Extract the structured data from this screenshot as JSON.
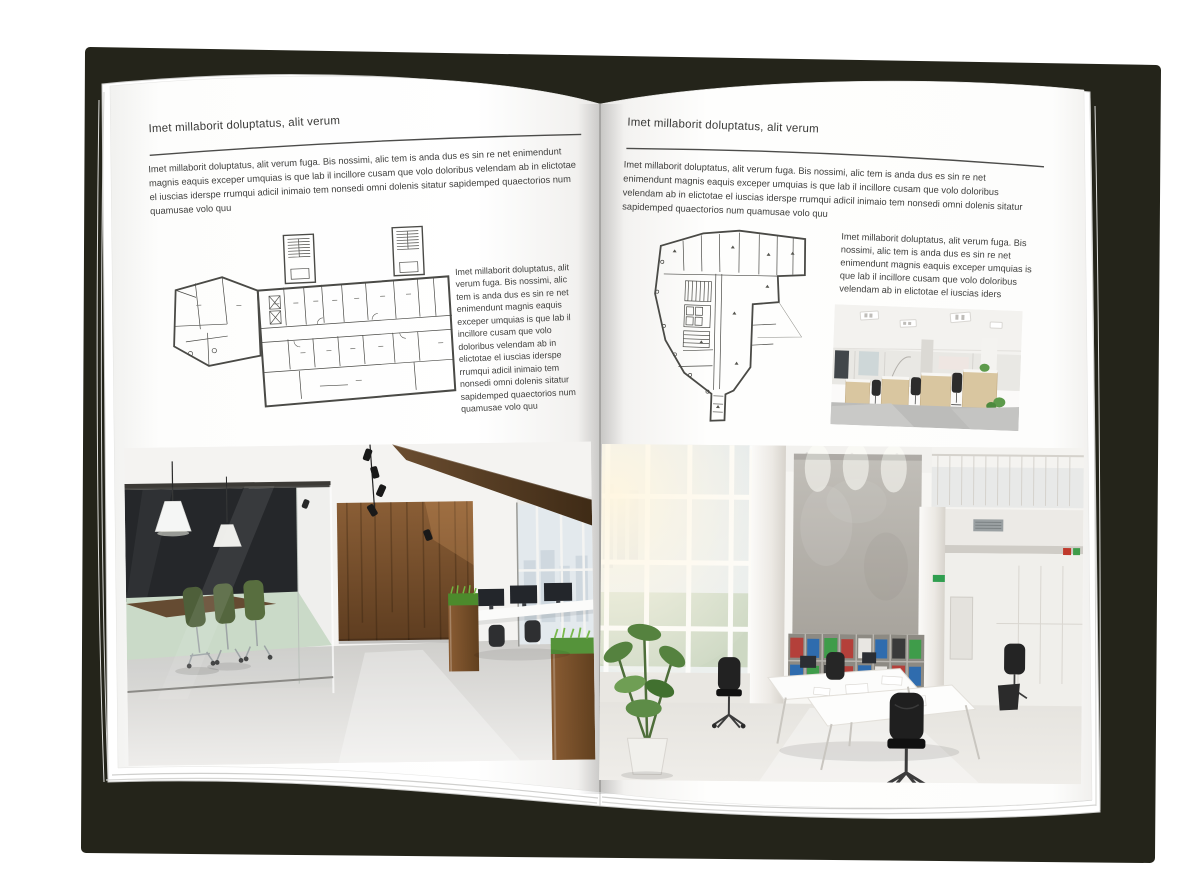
{
  "colors": {
    "cover": "#24241a",
    "page": "#ffffff",
    "heading_text": "#3a3a38",
    "body_text": "#3f3f3d",
    "rule": "#4c4c4a"
  },
  "left_page": {
    "header": "Imet millaborit doluptatus, alit verum",
    "intro": "Imet millaborit doluptatus, alit verum fuga. Bis nossimi, alic tem is anda dus es sin re net enimendunt magnis eaquis exceper umquias is que lab il incillore cusam que volo doloribus velendam ab in elictotae el iuscias iderspe rrumqui adicil inimaio tem nonsedi omni dolenis sitatur sapidemped quaectorios num quamusae volo quu",
    "side_text": "Imet millaborit doluptatus, alit verum fuga. Bis nossimi, alic tem is anda dus es sin re net enimendunt magnis eaquis exceper umquias is que lab il incillore cusam que volo doloribus velendam ab in elictotae el iuscias iderspe rrumqui adicil inimaio tem nonsedi omni dolenis sitatur sapidemped quaectorios num quamusae volo quu"
  },
  "right_page": {
    "header": "Imet millaborit doluptatus, alit verum",
    "intro": "Imet millaborit doluptatus, alit verum fuga. Bis nossimi, alic tem is anda dus es sin re net enimendunt magnis eaquis exceper umquias is que lab il incillore cusam que volo doloribus velendam ab in elictotae el iuscias iderspe rrumqui adicil inimaio tem nonsedi omni dolenis sitatur sapidemped quaectorios num quamusae volo quu",
    "side_text": "Imet millaborit doluptatus, alit verum fuga. Bis nossimi, alic tem is anda dus es sin re net enimendunt magnis eaquis exceper umquias is que lab il incillore cusam que volo doloribus velendam ab in elictotae el iuscias iders"
  }
}
